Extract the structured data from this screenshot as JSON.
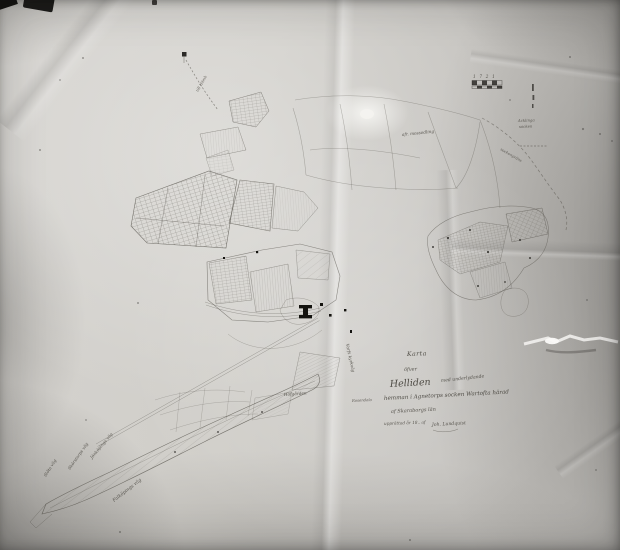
{
  "map": {
    "title_block": {
      "karta": "Karta",
      "ofver": "öfver",
      "estate": "Helliden",
      "estate_suffix": "med underlydande",
      "parish_line": "hemman i Agnetorps socken Wartofta härad",
      "county_line": "af Skaraborgs län",
      "credit_line": "upprättad år 18.. af",
      "signature": "Joh. Lundquist"
    },
    "labels": {
      "road_slota": "Slöta väg",
      "road_skorstorp": "Skörstorps väg",
      "road_jonkoping": "Jönköpings väg",
      "road_falkoping": "Falköpings väg",
      "road_kyrk": "Varfs kyrkväg",
      "farm_hofgarden": "Hofgården",
      "note_mossodling": "afr. mossodling",
      "note_rosendala": "Rosendala",
      "track_homb": "till Hömb",
      "boundary_note": "sockengräns",
      "right_note_1": "Acklinga",
      "right_note_2": "socken"
    },
    "scale_stamp": {
      "numbers": "1 7 2 1"
    }
  }
}
